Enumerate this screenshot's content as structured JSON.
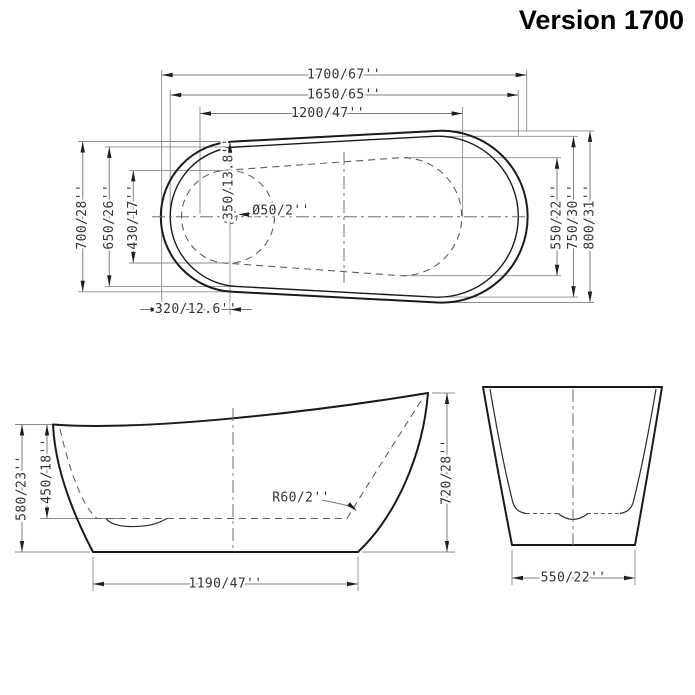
{
  "title": "Version 1700",
  "top_view": {
    "length_overall": "1700/67''",
    "length_rim": "1650/65''",
    "length_basin": "1200/47''",
    "width_left_overall": "700/28''",
    "width_left_rim": "650/26''",
    "width_left_basin": "430/17''",
    "drain_to_edge": "350/13.8''",
    "drain_diameter": "Ø50/2''",
    "width_right_basin": "550/22''",
    "width_right_rim": "750/30''",
    "width_right_overall": "800/31''",
    "drain_offset": "320/12.6''"
  },
  "side_view": {
    "height_left": "580/23''",
    "depth_inner": "450/18''",
    "height_right": "720/28''",
    "base_length": "1190/47''",
    "corner_radius": "R60/2''"
  },
  "end_view": {
    "base_width": "550/22''"
  }
}
